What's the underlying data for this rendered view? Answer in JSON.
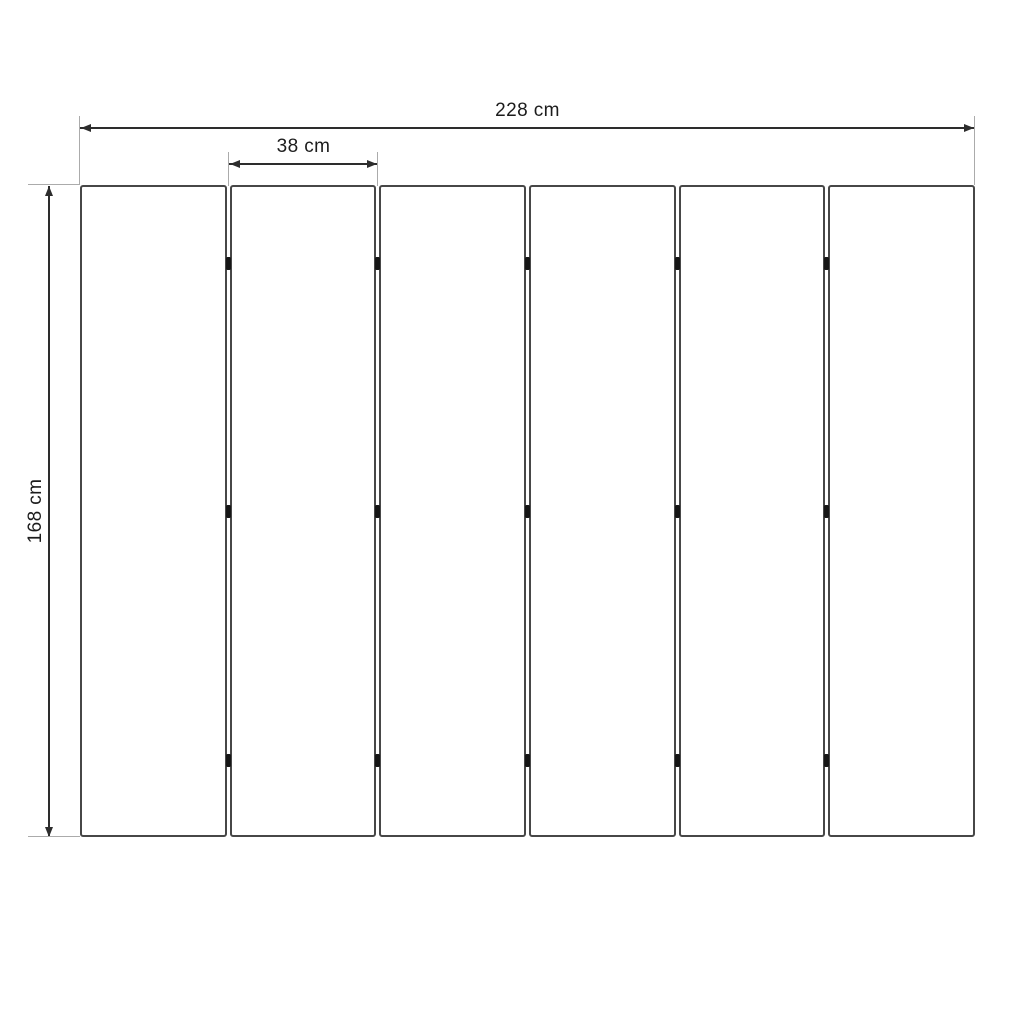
{
  "diagram": {
    "dimensions": {
      "total_width": {
        "label": "228 cm"
      },
      "panel_width": {
        "label": "38 cm"
      },
      "height": {
        "label": "168 cm"
      }
    },
    "panels": {
      "count": 6,
      "gap_count": 5,
      "hinges_per_gap": 3
    },
    "colors": {
      "panel_border": "#474747",
      "dimension_line": "#2d2d2d",
      "extension_line": "#ababab",
      "hinge": "#161616",
      "text": "#1c1c1c",
      "background": "#ffffff"
    }
  }
}
